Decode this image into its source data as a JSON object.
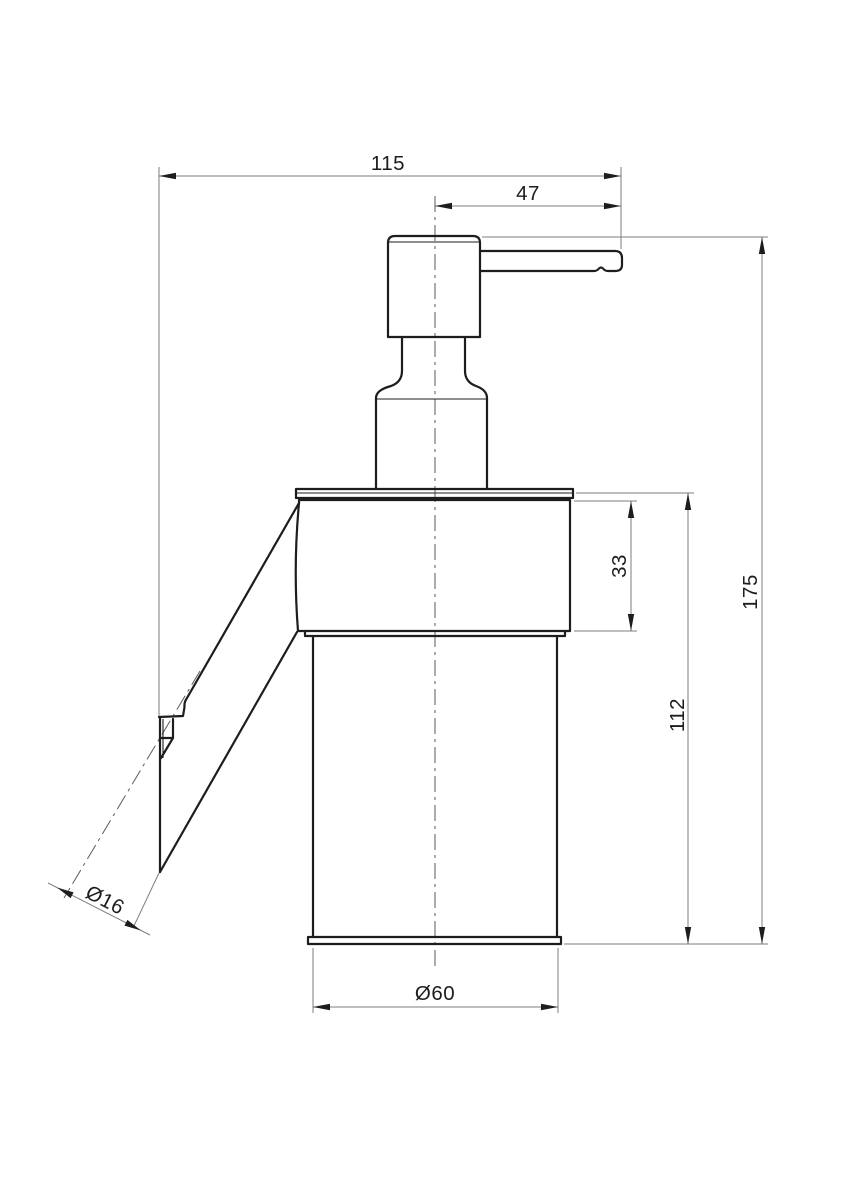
{
  "drawing": {
    "background": "#ffffff",
    "line_color": "#1d1d1b",
    "dim_line_color": "#7e7e7e",
    "dimensions": {
      "total_width": "115",
      "spout_projection": "47",
      "holder_height": "33",
      "total_height": "175",
      "body_height": "112",
      "mount_diameter": "Ø16",
      "body_diameter": "Ø60"
    }
  }
}
